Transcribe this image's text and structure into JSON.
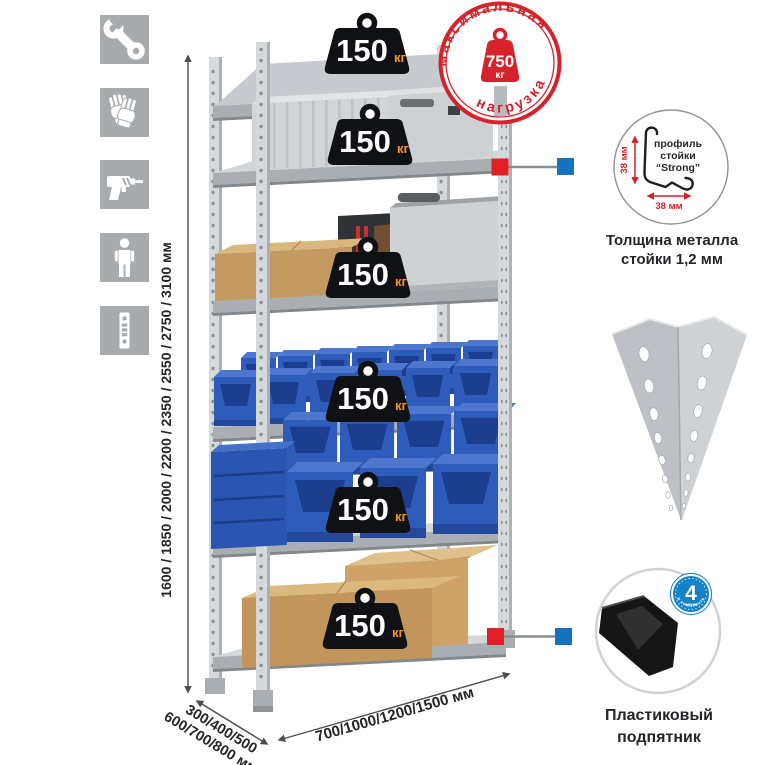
{
  "icon_panel": {
    "items": [
      {
        "name": "wrench"
      },
      {
        "name": "gloves"
      },
      {
        "name": "drill"
      },
      {
        "name": "person"
      },
      {
        "name": "post-profile"
      }
    ]
  },
  "height_dim": {
    "label": "1600 / 1850 / 2000 / 2200 / 2350 / 2550 / 2750 / 3100 мм"
  },
  "weights": {
    "value": "150",
    "unit": "кг"
  },
  "stamp": {
    "arc_top": "максимальная",
    "arc_bottom": "нагрузка",
    "value": "750",
    "unit": "кг"
  },
  "profile_detail": {
    "text_line1": "профиль",
    "text_line2": "стойки",
    "text_line3": "“Strong”",
    "dim_vertical": "38 мм",
    "dim_horizontal": "38 мм",
    "caption_line1": "Толщина металла",
    "caption_line2": "стойки 1,2 мм"
  },
  "foot_detail": {
    "badge_number": "4",
    "badge_word": "штуки",
    "badge_arc": "в комплекте",
    "caption_line1": "Пластиковый",
    "caption_line2": "подпятник"
  },
  "depth_dim": {
    "line1": "300/400/500",
    "line2": "600/700/800 мм"
  },
  "width_dim": {
    "label": "700/1000/1200/1500 мм"
  },
  "colors": {
    "stamp_red": "#d6232b",
    "marker_red": "#e01f26",
    "marker_blue": "#1472be",
    "badge_blue": "#1482c8",
    "weight_black": "#101114",
    "unit_orange": "#f7941e",
    "bin_blue": "#2e5cbb",
    "icon_gray": "#a8abae"
  }
}
